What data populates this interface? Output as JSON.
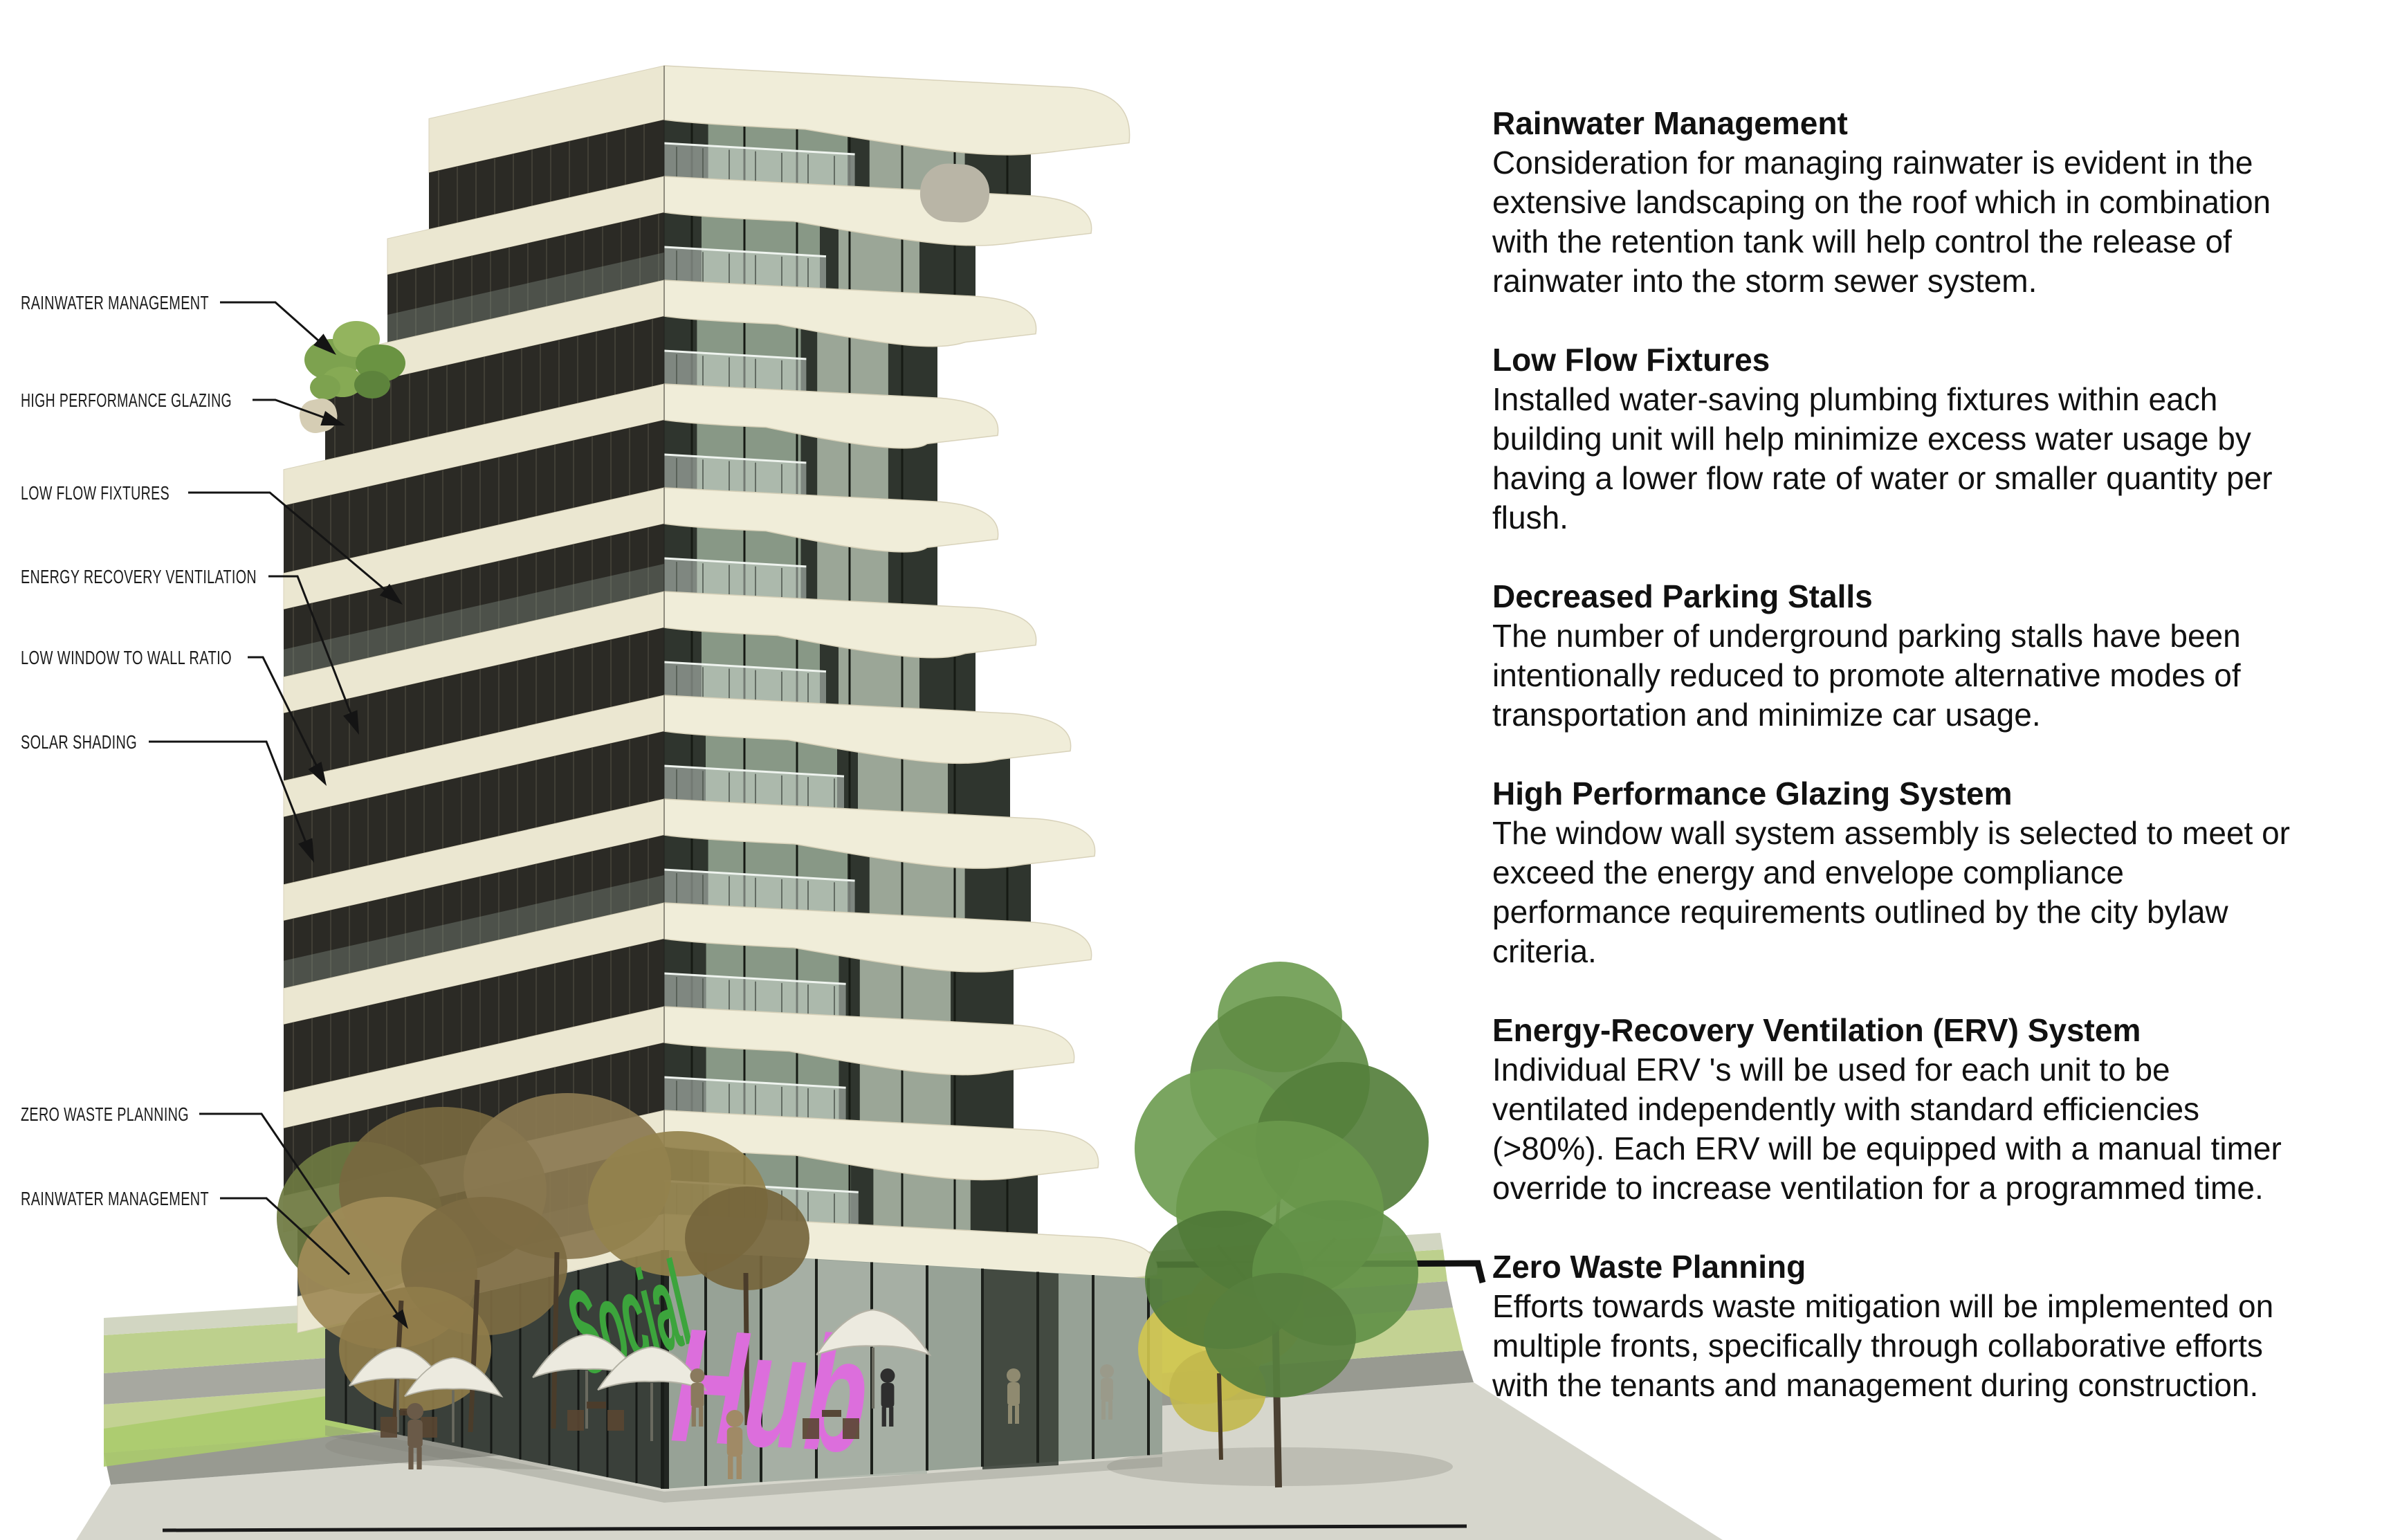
{
  "figure": {
    "type": "architectural-rendering",
    "building_sign_full": "SocialHub"
  },
  "sign": {
    "social": "Social",
    "hub": "Hub"
  },
  "callouts": [
    {
      "label": "RAINWATER MANAGEMENT"
    },
    {
      "label": "HIGH PERFORMANCE GLAZING"
    },
    {
      "label": "LOW FLOW FIXTURES"
    },
    {
      "label": "ENERGY RECOVERY VENTILATION"
    },
    {
      "label": "LOW WINDOW TO WALL RATIO"
    },
    {
      "label": "SOLAR SHADING"
    },
    {
      "label": "ZERO WASTE PLANNING"
    },
    {
      "label": "RAINWATER MANAGEMENT"
    }
  ],
  "sections": [
    {
      "heading": "Rainwater Management",
      "body": "Consideration for managing rainwater is evident in the\nextensive landscaping on the roof which in combination\nwith the retention tank will help control the release of\nrainwater into the storm sewer system."
    },
    {
      "heading": "Low Flow Fixtures",
      "body": "Installed water-saving plumbing fixtures within each\nbuilding unit will help minimize excess water usage by\nhaving a lower flow rate of water or smaller quantity per\nflush."
    },
    {
      "heading": "Decreased Parking Stalls",
      "body": "The number of underground parking stalls have been\nintentionally reduced to promote alternative modes of\ntransportation and minimize car usage."
    },
    {
      "heading": "High Performance Glazing System",
      "body": "The window wall system assembly is selected to meet or\nexceed the energy and envelope compliance\nperformance requirements outlined by the city bylaw\ncriteria."
    },
    {
      "heading": "Energy-Recovery Ventilation (ERV) System",
      "body": "Individual ERV 's will be used for each unit to be\nventilated independently with standard efficiencies\n(>80%). Each ERV will be equipped with a manual timer\noverride to increase ventilation for a programmed time."
    },
    {
      "heading": "Zero Waste Planning",
      "body": "Efforts towards waste mitigation will be implemented on\nmultiple fronts, specifically through collaborative efforts\nwith the tenants and management during construction."
    }
  ],
  "colors": {
    "slab_cream": "#f0edd9",
    "slab_edge": "#d8d2ba",
    "slab_left": "#ebe7d1",
    "glass_dark": "#2f352e",
    "glass_green": "#8d9e8b",
    "glass_green_light": "#a7b2a3",
    "left_face_dark": "#2b2a25",
    "mullion_dark": "#161a14",
    "mullion_left": "#45433a",
    "railing_glass": "#cfd9d2",
    "sign_green": "#3ca43c",
    "sign_pink": "#dc6edc",
    "grass": "#c3d293",
    "grass2": "#bdd08d",
    "grass_bright": "#abcb6d",
    "pavement": "#a7a8a0",
    "curb": "#989a91",
    "road": "#d6d6cc",
    "edge_strip": "#d2d6c2",
    "tree_green_1": "#5f8c44",
    "tree_green_2": "#6f9d52",
    "tree_green_3": "#557f3c",
    "tree_autumn_1": "#8a7850",
    "tree_autumn_2": "#77683f",
    "tree_autumn_3": "#94824d",
    "tree_autumn_4": "#6e7a41",
    "tree_autumn_5": "#a08b57",
    "tree_yellow": "#d2c64f",
    "trunk": "#4a3c2a",
    "umbrella": "#eceadf",
    "text": "#111111"
  }
}
